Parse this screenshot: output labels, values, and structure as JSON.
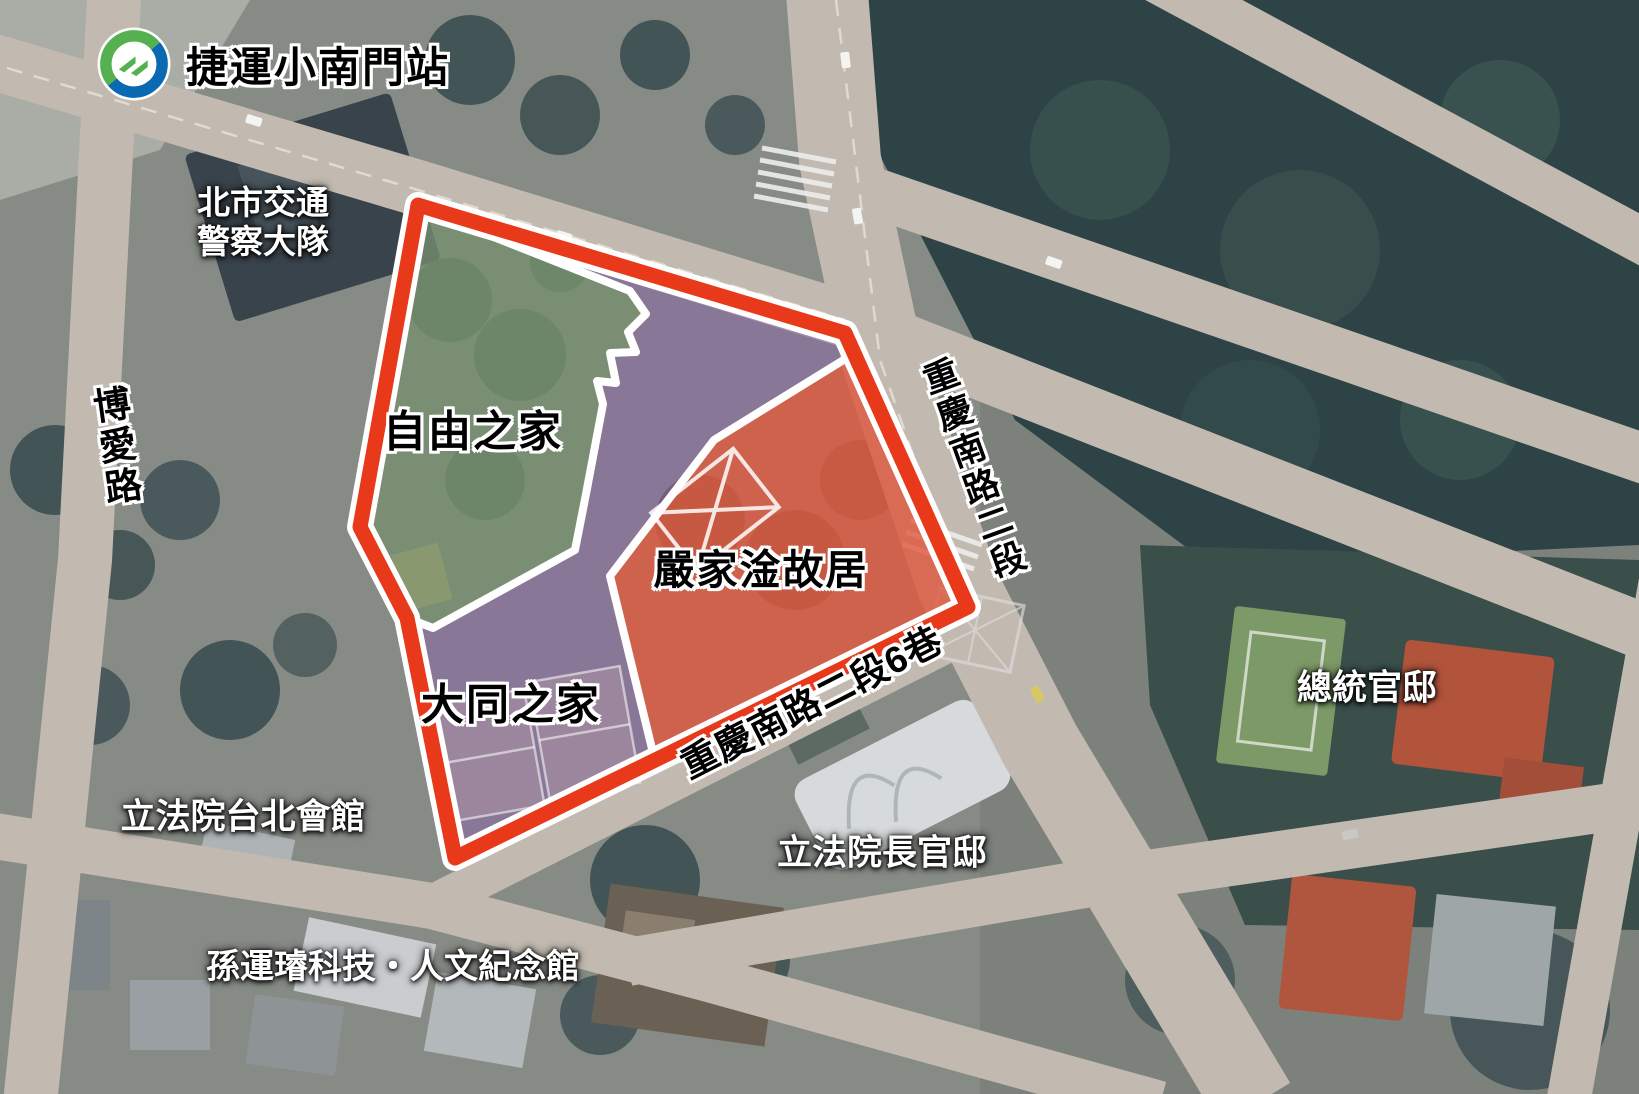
{
  "station": {
    "name": "捷運小南門站"
  },
  "zones": {
    "freedom_house": {
      "label": "自由之家",
      "color": "#6FA357"
    },
    "datong_home": {
      "label": "大同之家",
      "color": "#8A63A8"
    },
    "yen_residence": {
      "label": "嚴家淦故居",
      "color": "#F0572A"
    }
  },
  "roads": {
    "boai": {
      "label": "博愛路"
    },
    "chongqing_s2": {
      "label": "重慶南路二段"
    },
    "chongqing_s2_ln6": {
      "label": "重慶南路二段6巷"
    }
  },
  "places": {
    "traffic_police": {
      "line1": "北市交通",
      "line2": "警察大隊"
    },
    "presidential_residence": {
      "label": "總統官邸"
    },
    "ly_taipei_hall": {
      "label": "立法院台北會館"
    },
    "ly_chief_residence": {
      "label": "立法院長官邸"
    },
    "sun_yun_suan_memorial": {
      "label": "孫運璿科技・人文紀念館"
    }
  },
  "colors": {
    "boundary_red": "#E8391A",
    "boundary_white": "#FFFFFF",
    "zone_green_tint": "#6FA357",
    "zone_purple_tint": "#8A63A8",
    "zone_orange_tint": "#F8551E",
    "metro_logo_blue": "#0A69B0",
    "metro_logo_green": "#55B04F"
  }
}
